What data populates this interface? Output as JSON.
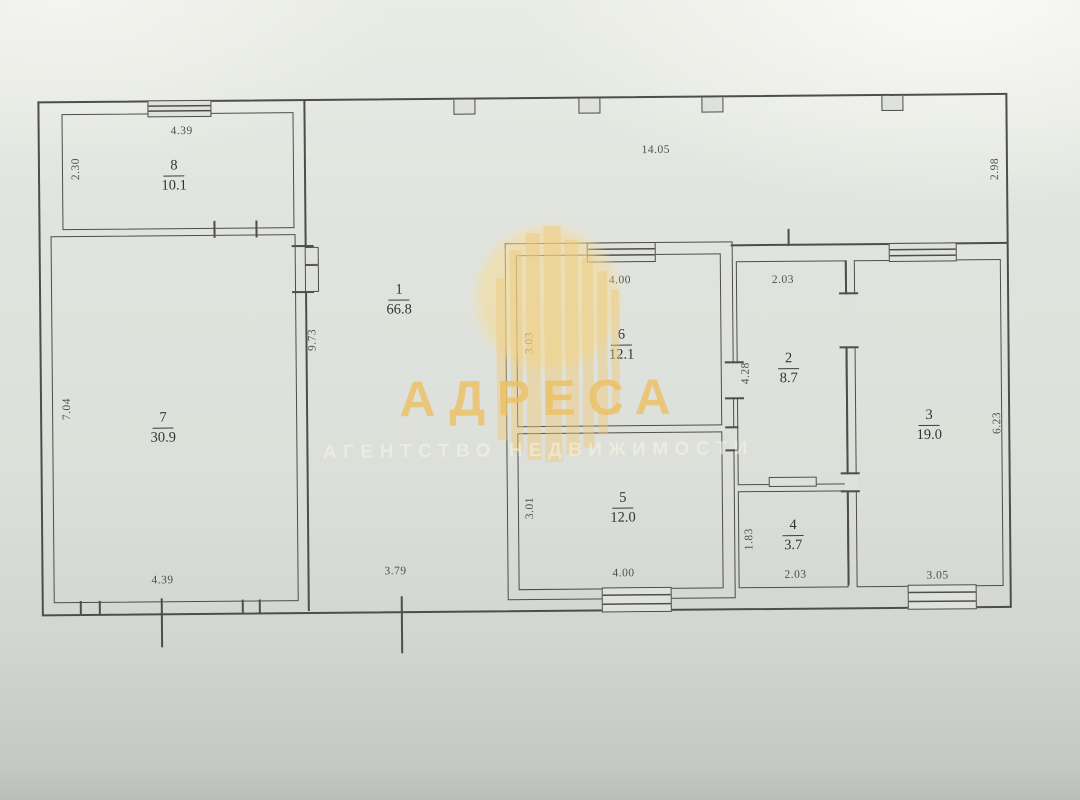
{
  "watermark": {
    "title": "АДРЕСА",
    "subtitle": "АГЕНТСТВО НЕДВИЖИМОСТИ"
  },
  "rooms": {
    "r1": {
      "number": "1",
      "area": "66.8"
    },
    "r2": {
      "number": "2",
      "area": "8.7"
    },
    "r3": {
      "number": "3",
      "area": "19.0"
    },
    "r4": {
      "number": "4",
      "area": "3.7"
    },
    "r5": {
      "number": "5",
      "area": "12.0"
    },
    "r6": {
      "number": "6",
      "area": "12.1"
    },
    "r7": {
      "number": "7",
      "area": "30.9"
    },
    "r8": {
      "number": "8",
      "area": "10.1"
    }
  },
  "dims": {
    "room8_top": "4.39",
    "room8_left": "2.30",
    "hall_top": "14.05",
    "hall_right": "2.98",
    "hall_wall": "9.73",
    "hall_bottom": "3.79",
    "room7_left": "7.04",
    "room7_bottom": "4.39",
    "room6_top": "4.00",
    "room6_left": "3.03",
    "room5_left": "3.01",
    "room5_bottom": "4.00",
    "room2_top": "2.03",
    "room2_left": "4.28",
    "room4_left": "1.83",
    "room4_bottom": "2.03",
    "room3_right": "6.23",
    "room3_bottom": "3.05"
  },
  "colors": {
    "paper": "#dfe2dc",
    "ink": "#4d4d4d",
    "watermark_accent": "#ecc164"
  }
}
